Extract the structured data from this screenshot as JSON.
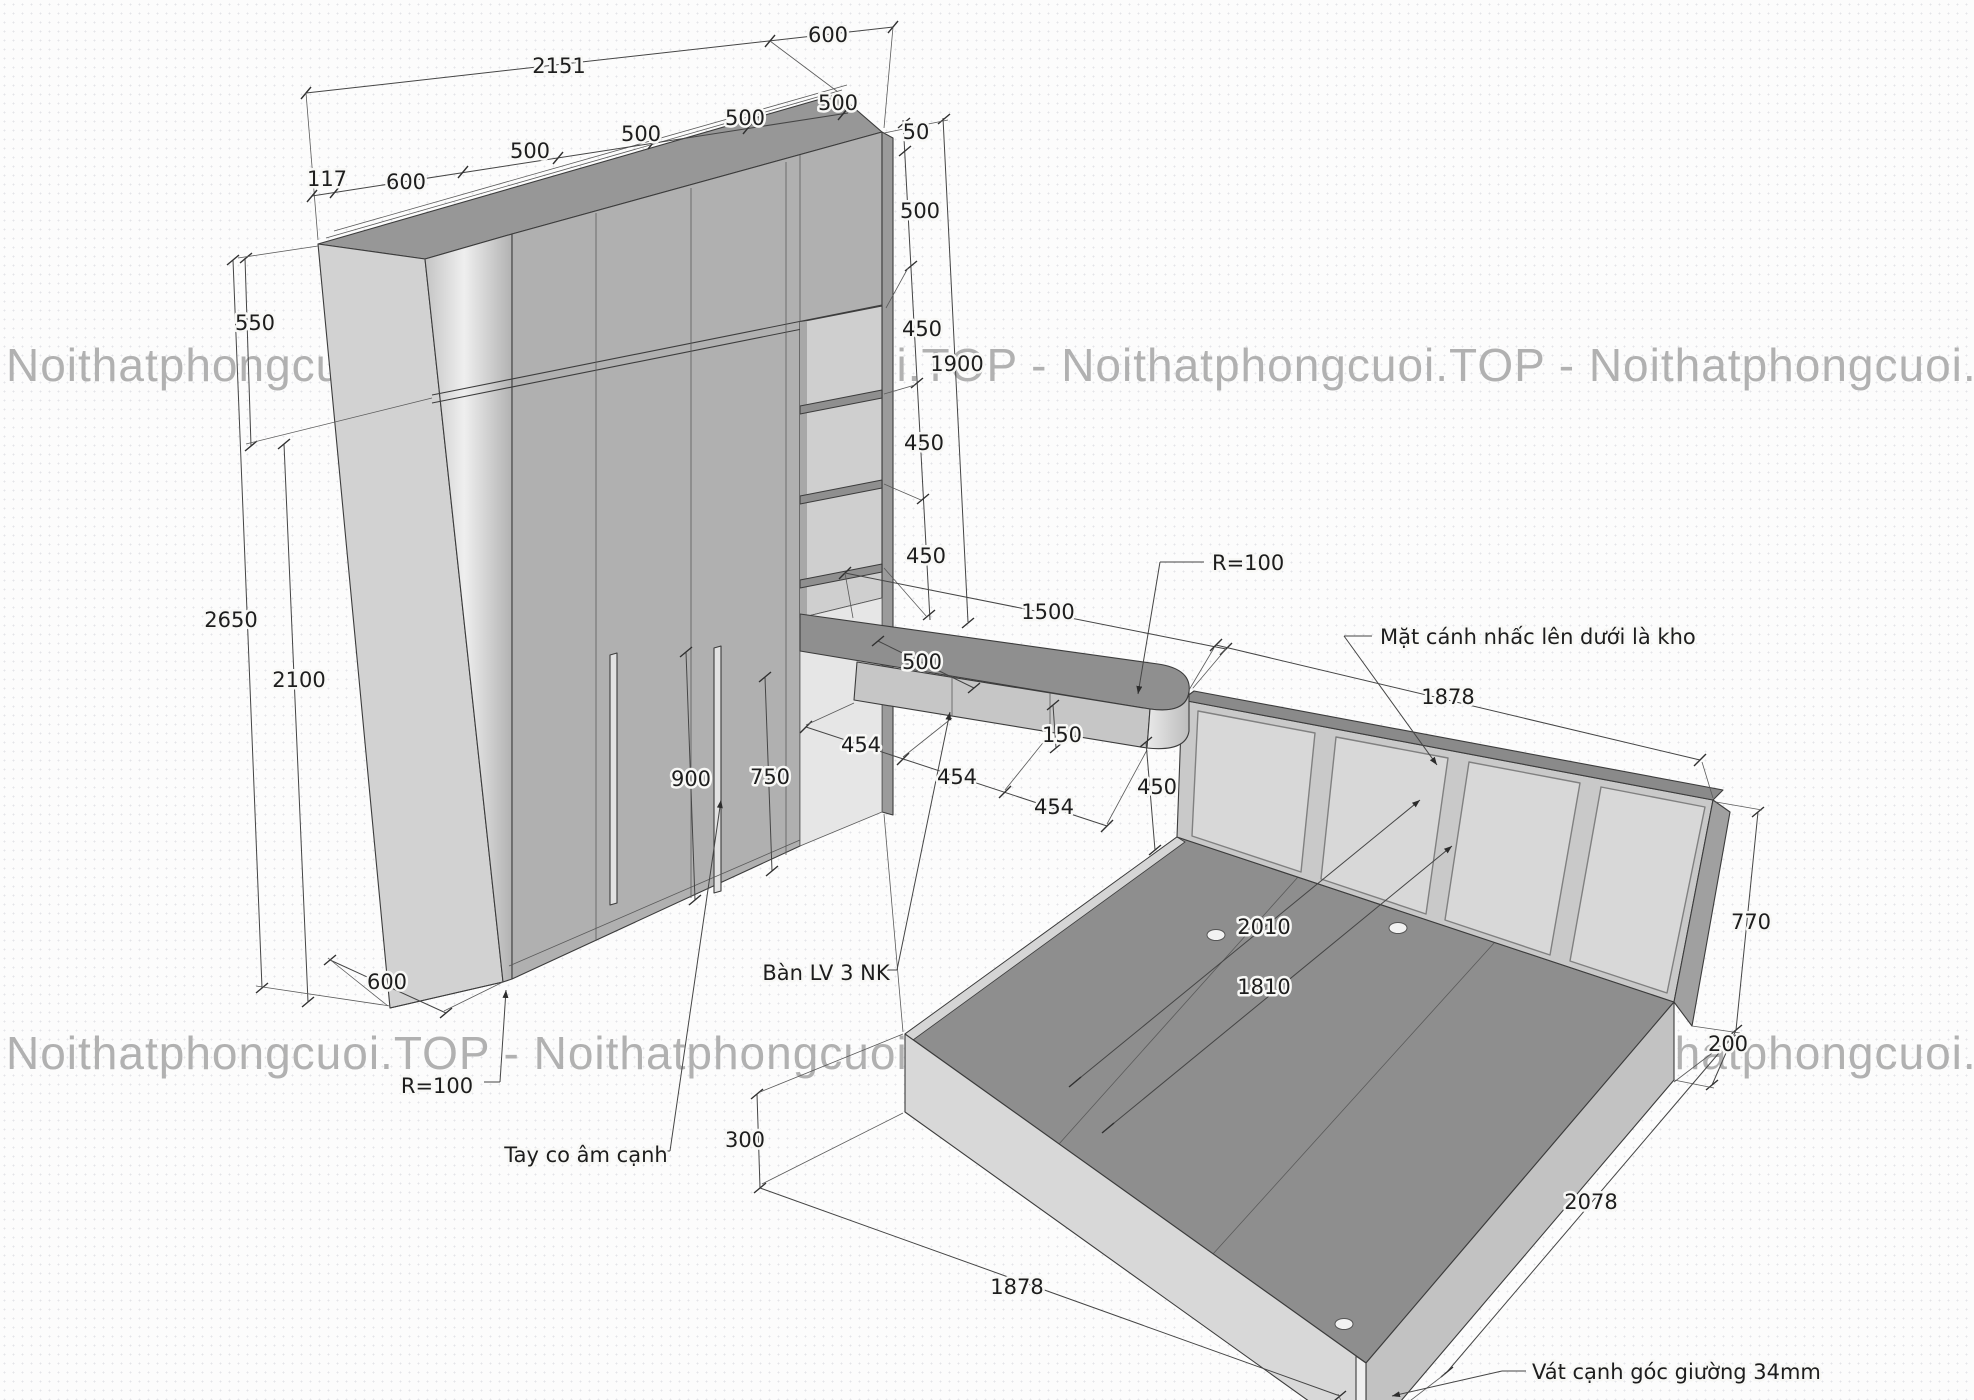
{
  "watermark": {
    "instance": "Noithatphongcuoi.TOP",
    "row": "Noithatphongcuoi.TOP - Noithatphongcuoi.TOP - Noithatphongcuoi.TOP - Noithatphongcuoi.TOP",
    "color": "#a5a5a5"
  },
  "drawing": {
    "title_hint": "Axonometric furniture drawing: wardrobe with open shelves, floating desk with drawers, platform bed with upholstered headboard",
    "colors": {
      "paper": "#fcfcfc",
      "front_face": "#b0b0b0",
      "top_face": "#979797",
      "side_panel": "#d2d2d2",
      "niche": "#cfcfcf",
      "desk_top": "#8f8f8f",
      "drawer": "#c6c6c6",
      "bed_deck": "#8e8e8e",
      "bed_front": "#d8d8d8",
      "headboard_panel": "#d8d8d8",
      "line": "#3c3c3c"
    }
  },
  "labels": {
    "dim_2151": "2151",
    "dim_600_top": "600",
    "dim_117": "117",
    "dim_600_left_top": "600",
    "dim_500_d1": "500",
    "dim_500_d2": "500",
    "dim_500_d3": "500",
    "dim_500_d4": "500",
    "dim_50": "50",
    "dim_500_right": "500",
    "dim_450_r1": "450",
    "dim_1900": "1900",
    "dim_450_r2": "450",
    "dim_450_r3": "450",
    "dim_550": "550",
    "dim_2650": "2650",
    "dim_2100": "2100",
    "dim_900": "900",
    "dim_750": "750",
    "dim_1500": "1500",
    "radius_desk": "R=100",
    "dim_500_desk": "500",
    "dim_454_a": "454",
    "dim_454_b": "454",
    "dim_454_c": "454",
    "dim_150": "150",
    "dim_450_desk": "450",
    "note_headboard": "Mặt cánh nhấc lên dưới là kho",
    "dim_1878_headboard": "1878",
    "dim_2010": "2010",
    "dim_1810": "1810",
    "dim_770": "770",
    "dim_200": "200",
    "dim_600_base": "600",
    "radius_base": "R=100",
    "note_handle": "Tay co âm cạnh",
    "dim_300": "300",
    "dim_1878_bed": "1878",
    "dim_2078": "2078",
    "note_desk": "Bàn LV 3 NK",
    "note_chamfer": "Vát cạnh góc giường 34mm"
  }
}
